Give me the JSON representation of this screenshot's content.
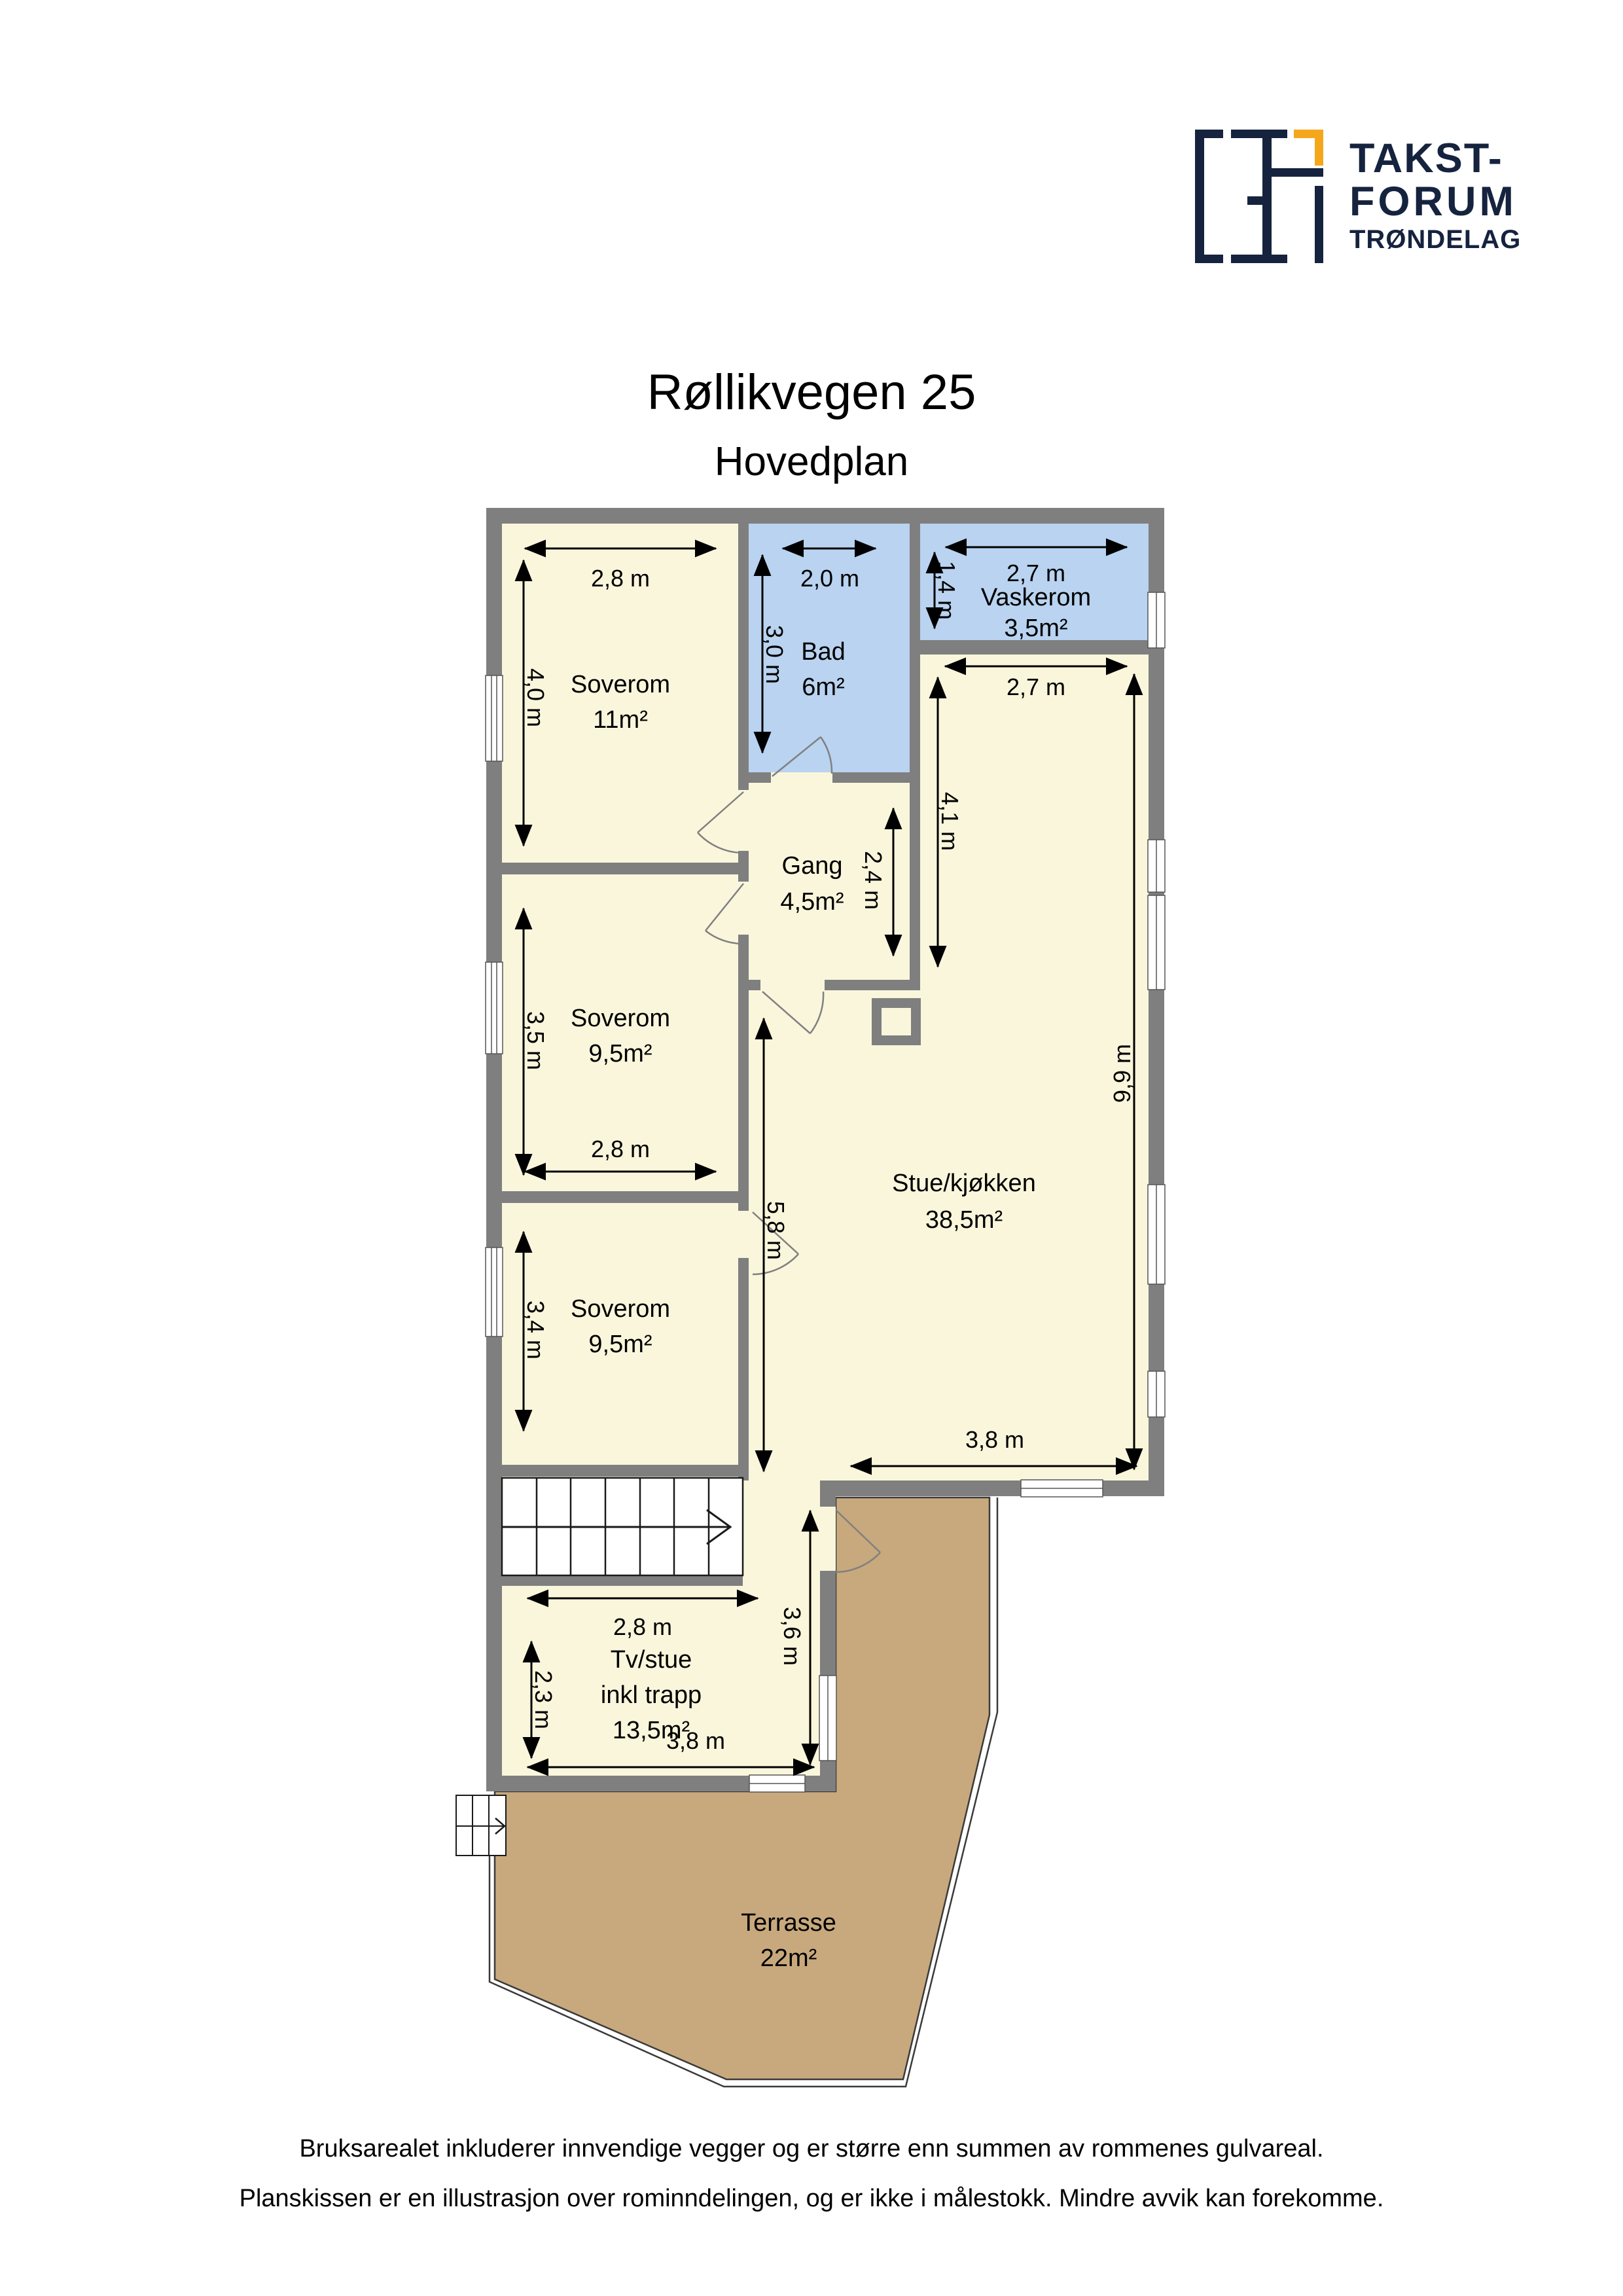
{
  "header": {
    "logo": {
      "line1": "TAKST-",
      "line2": "FORUM",
      "line3": "TRØNDELAG"
    },
    "title": "Røllikvegen 25",
    "subtitle": "Hovedplan"
  },
  "rooms": [
    {
      "name": "Soverom",
      "area": "11m²"
    },
    {
      "name": "Bad",
      "area": "6m²"
    },
    {
      "name": "Vaskerom",
      "area": "3,5m²"
    },
    {
      "name": "Gang",
      "area": "4,5m²"
    },
    {
      "name": "Soverom",
      "area": "9,5m²"
    },
    {
      "name": "Soverom",
      "area": "9,5m²"
    },
    {
      "name": "Stue/kjøkken",
      "area": "38,5m²"
    },
    {
      "name": "Tv/stue",
      "name2": "inkl trapp",
      "area": "13,5m²"
    },
    {
      "name": "Terrasse",
      "area": "22m²"
    }
  ],
  "dimensions": {
    "sov1_w": "2,8 m",
    "sov1_h": "4,0 m",
    "bad_w": "2,0 m",
    "bad_h": "3,0 m",
    "vask_w": "2,7 m",
    "vask_h": "1,4 m",
    "stue_w": "2,7 m",
    "stue_h_upper": "4,1 m",
    "gang_h": "2,4 m",
    "sov2_h": "3,5 m",
    "sov2_w": "2,8 m",
    "hall_h": "5,8 m",
    "stue_h": "9,9 m",
    "sov3_h": "3,4 m",
    "stue_bottom_w": "3,8 m",
    "tv_w": "2,8 m",
    "tv_h": "2,3 m",
    "tv_bottom_w": "3,8 m",
    "tv_right_h": "3,6 m"
  },
  "footer": {
    "line1": "Bruksarealet inkluderer innvendige vegger og er større enn summen av rommenes gulvareal.",
    "line2": "Planskissen er en illustrasjon over rominndelingen, og er ikke i målestokk. Mindre avvik kan forekomme."
  },
  "colors": {
    "wall": "#7f7f7f",
    "room": "#faf6dc",
    "wet_room": "#b9d3f0",
    "terrace": "#c8a97d",
    "outline": "#3a3a3a",
    "logo_navy": "#15233f",
    "logo_orange": "#f5a71b"
  }
}
